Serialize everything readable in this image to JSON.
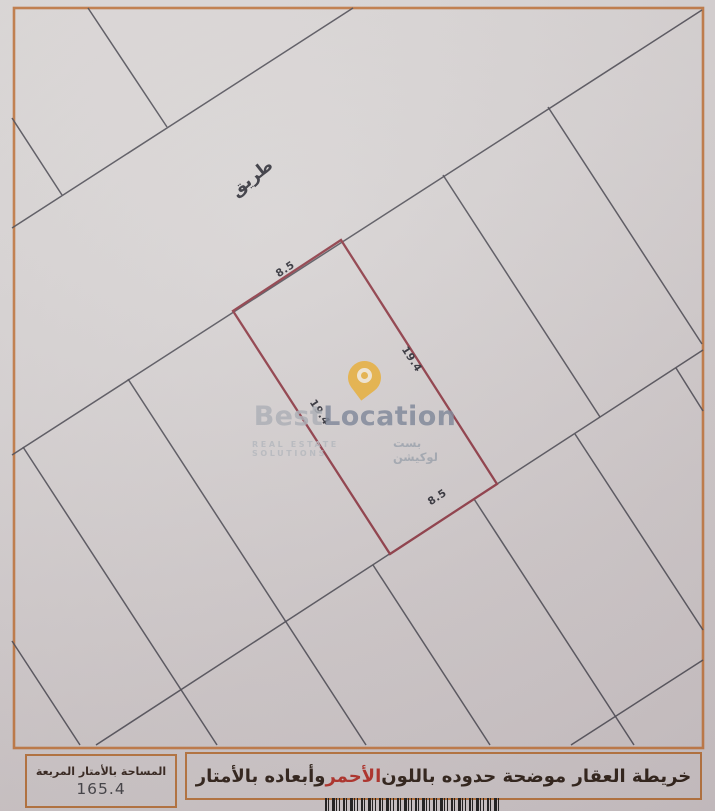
{
  "map": {
    "road_label": "طريق",
    "plot": {
      "top_width": "8.5",
      "bottom_width": "8.5",
      "left_depth": "19.4",
      "right_depth": "19.4",
      "outline_color": "#8d3a45"
    },
    "frame_color": "#c07a46",
    "parcel_line_color": "#4b4a53"
  },
  "watermark": {
    "brand_first": "Best",
    "brand_second": "Location",
    "tagline_en": "REAL ESTATE SOLUTIONS",
    "tagline_ar": "بست لوكيشن",
    "pin_color": "#e8ab2e"
  },
  "footer": {
    "area_box": {
      "label": "المساحة بالأمتار المربعة",
      "value": "165.4"
    },
    "note": {
      "prefix": "خريطة العقار موضحة حدوده باللون ",
      "highlight": "الأحمر",
      "suffix": " وأبعاده بالأمتار",
      "highlight_color": "#b03028"
    }
  }
}
